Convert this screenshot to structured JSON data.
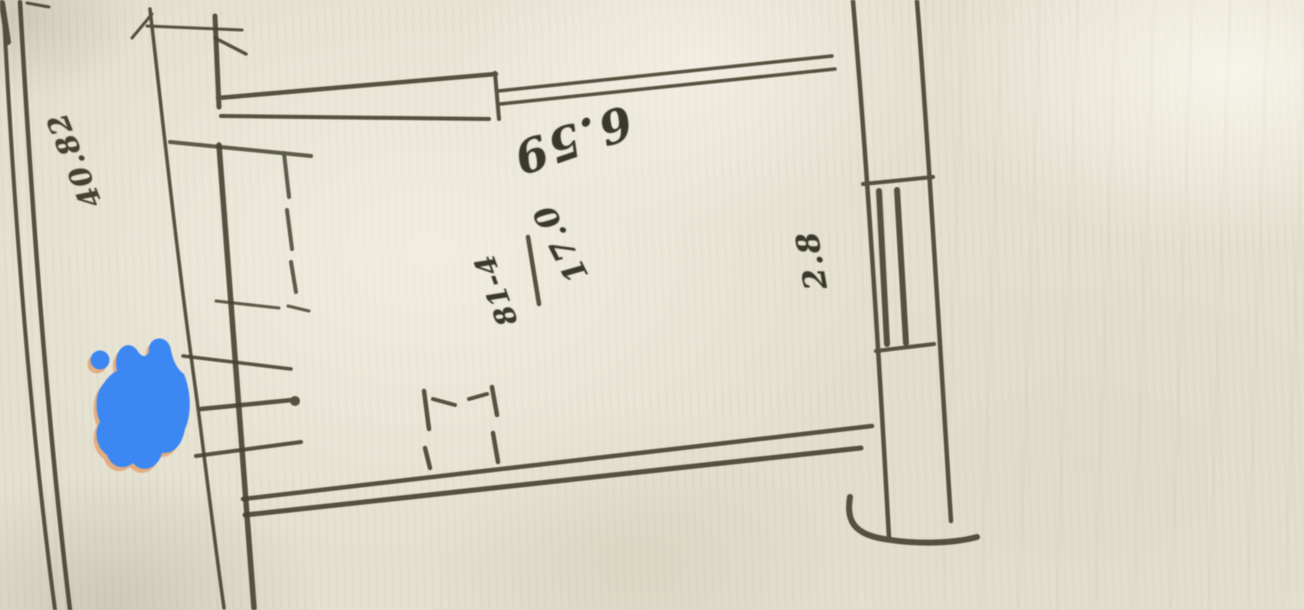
{
  "description": "Photograph of a hand-drawn apartment floor plan sketch (technical-passport style). The drawing is upside down relative to the photo: all handwritten figures appear rotated 180 degrees. A bright blue marker blob covers part of the left corridor wall.",
  "room": {
    "number": "81-4",
    "area": "17.0"
  },
  "dimensions": {
    "top_wall": "6.59",
    "right_wall": "2.8",
    "left_wall": "40.82"
  },
  "features": [
    "double-line exterior wall on far left",
    "double-line interior corridor wall",
    "top wall with thick and thin double-line segments",
    "right wall with window symbol (sill ticks and two mullion lines)",
    "dashed built-in closet outline near top-left of room",
    "dashed doorway opening marks on bottom wall",
    "curved wall-end stroke at bottom right",
    "blue marker blob with orange fringe"
  ],
  "colors": {
    "paper": "#e4e0cf",
    "ink": "#45422f",
    "marker_blue": "#3c87f2",
    "marker_halo": "#e6874a"
  }
}
